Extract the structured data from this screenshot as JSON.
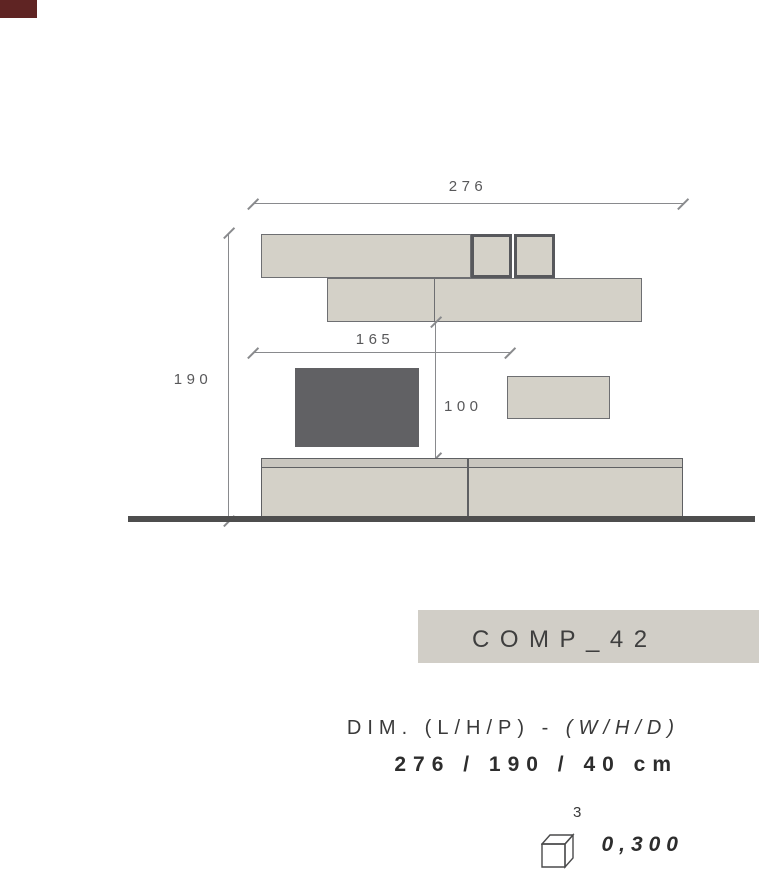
{
  "colors": {
    "corner_tab": "#5f2423",
    "unit_fill": "#d4d1c8",
    "unit_border": "#6e6f72",
    "accent_border": "#57585c",
    "tv_fill": "#616164",
    "base_strip_fill": "#c9c6bf",
    "base_border": "#5f6063",
    "floor": "#4e4e4e",
    "dim_line": "#898a8d",
    "dim_text": "#58585a",
    "label_box_bg": "#d1cec7",
    "text_dark": "#3a3a3a",
    "text_bold": "#2d2d2d"
  },
  "drawing": {
    "overall_width": "276",
    "overall_height": "190",
    "partial_width": "165",
    "partial_height": "100"
  },
  "label_box": {
    "text": "COMP_42"
  },
  "dimensions": {
    "heading_prefix": "DIM. (L/H/P) - ",
    "heading_metric": "(W/H/D)",
    "value": "276 / 190 / 40 cm"
  },
  "volume": {
    "icon": "cube-icon",
    "exponent": "3",
    "value": "0,300"
  }
}
